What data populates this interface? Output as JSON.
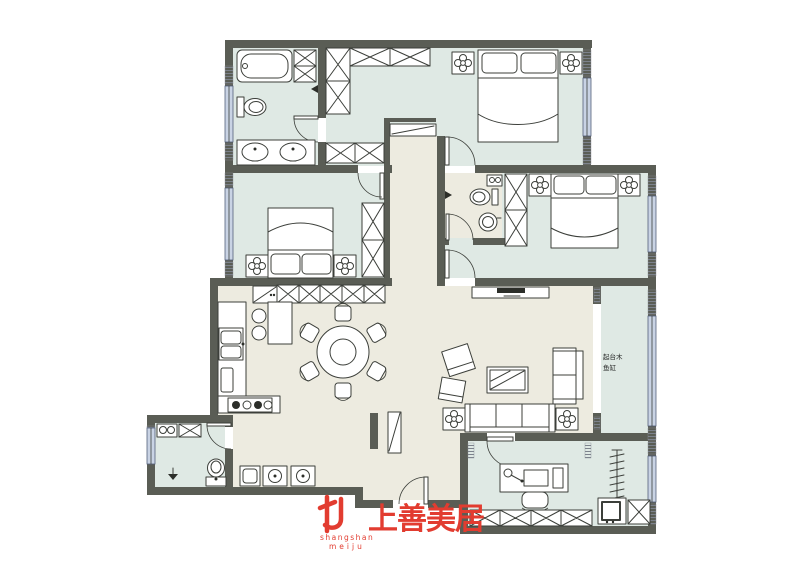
{
  "branding": {
    "logo_mark": "shangshan-meiju-logo",
    "logo_text": "上善美居",
    "logo_romanized_line1": "shangshan",
    "logo_romanized_line2": "meiju"
  },
  "annotations": {
    "balcony_line1": "起台木",
    "balcony_line2": "鱼缸"
  },
  "palette": {
    "wall": "#5a5d55",
    "floor_warm": "#edebe0",
    "floor_cool": "#dfe9e4",
    "window": "#c9d3e4",
    "accent_red": "#e23c30",
    "line": "#3c3f3a",
    "background": "#ffffff"
  }
}
